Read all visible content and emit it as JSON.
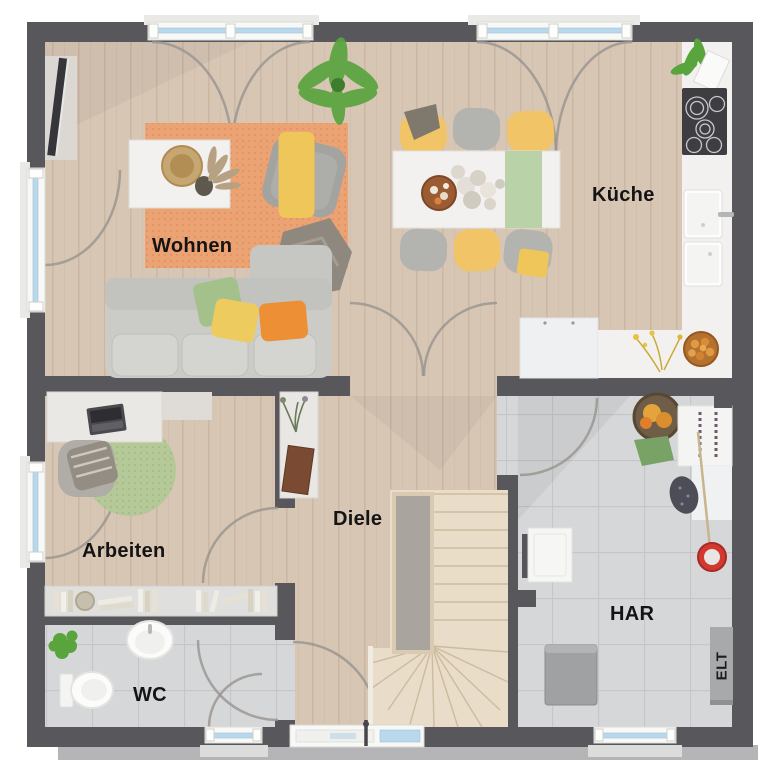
{
  "rooms": [
    {
      "id": "wohnen",
      "label": "Wohnen"
    },
    {
      "id": "kueche",
      "label": "Küche"
    },
    {
      "id": "arbeiten",
      "label": "Arbeiten"
    },
    {
      "id": "diele",
      "label": "Diele"
    },
    {
      "id": "wc",
      "label": "WC"
    },
    {
      "id": "har",
      "label": "HAR"
    },
    {
      "id": "elt",
      "label": "ELT"
    }
  ],
  "palette": {
    "wall": "#58585c",
    "wall_outer": "#a8a8aa",
    "wood": "#d8c6b5",
    "wood_grain": "#c2ab96",
    "wood_stairs": "#e9dcc8",
    "stair_well": "#a9a59e",
    "tile": "#d6d7d9",
    "tile_grout": "#c5c6c8",
    "rug": "#eca373",
    "rug_dot": "#dd8c5c",
    "rug_office": "#b5c897",
    "white_furniture": "#f2f1ef",
    "sofa": "#cbcbc7",
    "chair_gray": "#b3b3af",
    "chair_yellow": "#f0c467",
    "runner_green": "#bad2a7",
    "pillow_green": "#a4c08b",
    "pillow_yellow": "#eecb5f",
    "pillow_orange": "#ec8f35",
    "blanket_taupe": "#8f887e",
    "blanket_yellow": "#efc659",
    "cooktop": "#3e3e42",
    "glass": "#b9d8ec",
    "frame": "#f8f8f6",
    "arc": "#97948f",
    "label": "#141414",
    "elt_bg": "#a7a9ab",
    "bucket_red": "#d23a31",
    "basket_brown": "#6f5d48",
    "clothes_orange": "#e5a33c",
    "cloth_green": "#79a266",
    "bin_gray": "#9fa1a3",
    "plant_green": "#5aa43e",
    "book_brown": "#7a4a33"
  }
}
